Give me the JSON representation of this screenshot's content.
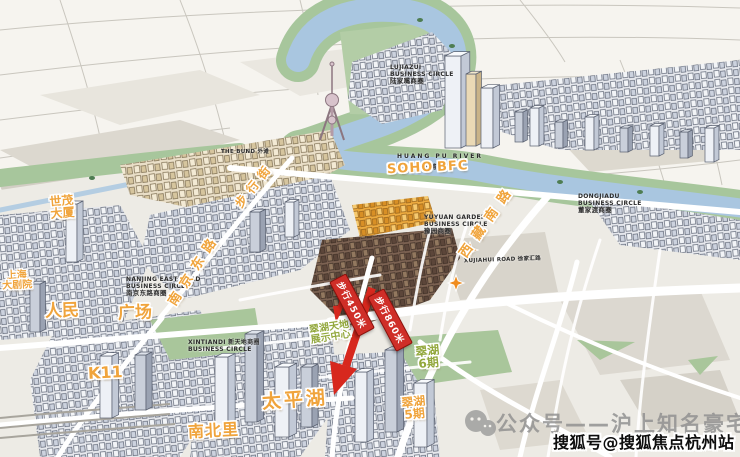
{
  "landmarks": {
    "grand_theatre": {
      "line1": "上海",
      "line2": "大剧院"
    },
    "shimao": {
      "line1": "世茂",
      "line2": "大厦"
    },
    "renmin": "人民",
    "guangchang": "广场",
    "k11": "K11",
    "nanbeili": "南北里",
    "taipinghu": "太平湖",
    "soho": "SOHO",
    "bfc": "BFC",
    "cuihu6": {
      "line1": "翠湖",
      "line2": "6期"
    },
    "cuihu5": {
      "line1": "翠湖",
      "line2": "5期"
    },
    "display_center": {
      "line1": "翠湖天地",
      "line2": "展示中心"
    }
  },
  "roads": {
    "nanjing_east": "南京东路",
    "pedestrian": "步行街",
    "xizang_south": "西藏南路"
  },
  "captions": {
    "huangpu_en": "HUANG PU RIVER",
    "huangpu_cn": "黄浦江",
    "lujiazui_en1": "LUJIAZUI",
    "lujiazui_en2": "BUSINESS CIRCLE",
    "lujiazui_cn": "陆家嘴商圈",
    "bund": "THE BUND 外滩",
    "nanjing_en1": "NANJING EAST ROAD",
    "nanjing_en2": "BUSINESS CIRCLE",
    "nanjing_cn": "南京东路商圈",
    "yuyuan_en1": "YUYUAN GARDEN",
    "yuyuan_en2": "BUSINESS CIRCLE",
    "yuyuan_cn": "豫园商圈",
    "dongjiadu_en1": "DONGJIADU",
    "dongjiadu_en2": "BUSINESS CIRCLE",
    "dongjiadu_cn": "董家渡商圈",
    "xintiandi_ln1": "XINTIANDI 新天地商圈",
    "xintiandi_ln2": "BUSINESS CIRCLE",
    "xujiahui": "XUJIAHUI ROAD 徐家汇路"
  },
  "distance_tags": {
    "tag1": "步行450米",
    "tag2": "步行860米"
  },
  "watermark": {
    "wechat_label": "公众号——沪上知名豪宅",
    "sohu_label": "搜狐号@搜狐焦点杭州站"
  },
  "colors": {
    "label_orange": "#f0a43c",
    "label_green": "#93a83d",
    "arrow_red": "#d7281e",
    "river_blue": "#a9c6e0",
    "bank_green": "#a7c69c"
  }
}
